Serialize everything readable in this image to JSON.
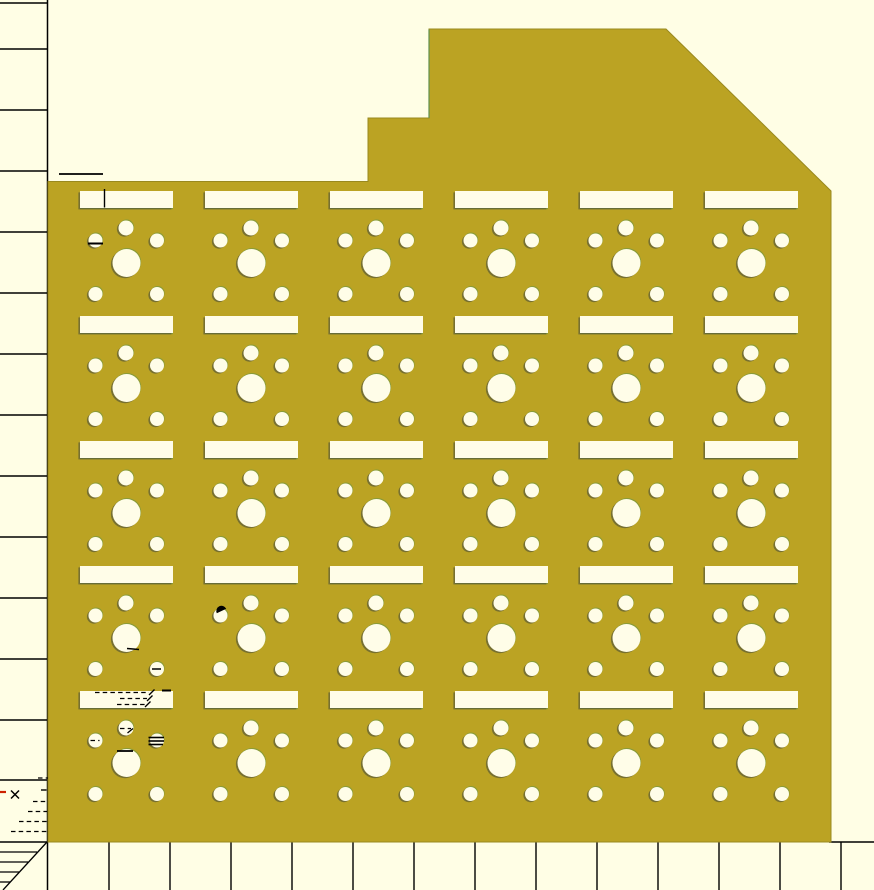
{
  "viewport": {
    "width": 874,
    "height": 890,
    "tool": "cad-preview-canvas"
  },
  "colors": {
    "background": "#fffee5",
    "panel": "#bba323",
    "panel_edge": "#99891f",
    "hole": "#fffde8",
    "line": "#000000",
    "accent_red": "#cc2200",
    "edge_green_line": "#5f9150",
    "shadow": "rgba(90,90,55,0.70)",
    "highlight_green": "rgba(95,150,75,0.55)"
  },
  "panel": {
    "outline": [
      [
        48,
        181.5
      ],
      [
        368,
        181.5
      ],
      [
        368,
        118
      ],
      [
        429,
        118
      ],
      [
        429,
        29
      ],
      [
        666,
        29
      ],
      [
        831,
        191
      ],
      [
        831,
        842
      ],
      [
        48,
        842
      ]
    ],
    "green_edge": [
      429,
      29.5,
      429,
      118
    ]
  },
  "cell_grid": {
    "columns_x": [
      80,
      205,
      330,
      455,
      580,
      705
    ],
    "rows_y": [
      191,
      316,
      441,
      566,
      691
    ],
    "slot": {
      "w": 93,
      "h": 17
    },
    "holes": [
      {
        "dx": 46,
        "dy": 37,
        "r": 7.5,
        "name": "top-hole"
      },
      {
        "dx": 15.5,
        "dy": 49.5,
        "r": 7,
        "name": "left-hole"
      },
      {
        "dx": 77,
        "dy": 49.5,
        "r": 7,
        "name": "right-hole"
      },
      {
        "dx": 46.5,
        "dy": 72,
        "r": 14,
        "name": "center-hole"
      },
      {
        "dx": 15.5,
        "dy": 103,
        "r": 7,
        "name": "bottom-left-hole"
      },
      {
        "dx": 77,
        "dy": 103,
        "r": 7,
        "name": "bottom-right-hole"
      }
    ]
  },
  "rulers": {
    "axis_x": 47.5,
    "left_tick_ys": [
      3,
      49,
      110,
      171,
      232,
      293,
      354,
      415,
      476,
      537,
      598,
      659,
      720,
      780
    ],
    "bottom_tick_xs": [
      109,
      170,
      231,
      292,
      353,
      414,
      475,
      536,
      597,
      658,
      719,
      780,
      841
    ],
    "bottom_tick_y1": 842,
    "bottom_tick_y2": 890,
    "baseline_y": 842,
    "baseline_segments": [
      [
        0,
        48
      ],
      [
        829,
        874
      ]
    ],
    "corner_hatch": {
      "lines": [
        [
          0,
          852,
          37,
          852
        ],
        [
          0,
          862,
          28,
          862
        ],
        [
          0,
          872,
          19,
          872
        ],
        [
          0,
          882,
          10,
          882
        ]
      ],
      "diagonal": [
        47,
        842,
        3,
        890
      ]
    }
  },
  "marks": [
    {
      "t": "l",
      "p": [
        59,
        174,
        103,
        174
      ],
      "w": 1.8
    },
    {
      "t": "l",
      "p": [
        104.5,
        189,
        104.5,
        207.5
      ],
      "w": 1.4
    },
    {
      "t": "l",
      "p": [
        88,
        243.5,
        103,
        243.5
      ],
      "w": 2
    },
    {
      "t": "wedge",
      "c": [
        221.5,
        611
      ],
      "r": 5.2,
      "a": -25
    },
    {
      "t": "l",
      "p": [
        127,
        648.5,
        139,
        649.5
      ],
      "w": 1.5
    },
    {
      "t": "l",
      "p": [
        152,
        669,
        161,
        669
      ],
      "w": 1.5
    },
    {
      "t": "d",
      "p": [
        95,
        692.5,
        149,
        692.5
      ],
      "w": 1.3
    },
    {
      "t": "l",
      "p": [
        149,
        695,
        154.5,
        689.5
      ],
      "w": 1.3
    },
    {
      "t": "d",
      "p": [
        120,
        698.5,
        147,
        698.5
      ],
      "w": 1.3
    },
    {
      "t": "l",
      "p": [
        147,
        701,
        152.5,
        695.5
      ],
      "w": 1.3
    },
    {
      "t": "d",
      "p": [
        117,
        704.5,
        145,
        704.5
      ],
      "w": 1.3
    },
    {
      "t": "l",
      "p": [
        145,
        707,
        150.5,
        701.5
      ],
      "w": 1.3
    },
    {
      "t": "l",
      "p": [
        162,
        690.5,
        171,
        690.5
      ],
      "w": 2
    },
    {
      "t": "d",
      "p": [
        120,
        728.5,
        131,
        728.5
      ],
      "w": 1.3
    },
    {
      "t": "l",
      "p": [
        127.5,
        733,
        133,
        728.5
      ],
      "w": 1.3
    },
    {
      "t": "d",
      "p": [
        90.5,
        740.5,
        99.5,
        740.5
      ],
      "w": 1.3
    },
    {
      "t": "l",
      "p": [
        148.5,
        737.5,
        164,
        737.5
      ],
      "w": 1.6
    },
    {
      "t": "l",
      "p": [
        148.5,
        741,
        164,
        741
      ],
      "w": 1.6
    },
    {
      "t": "l",
      "p": [
        148.5,
        744.5,
        163,
        744.5
      ],
      "w": 1.6
    },
    {
      "t": "l",
      "p": [
        117,
        751,
        133,
        751
      ],
      "w": 1.8
    },
    {
      "t": "d",
      "p": [
        38,
        778,
        48,
        778
      ],
      "w": 1.3
    },
    {
      "t": "l",
      "p": [
        0,
        792,
        6,
        792
      ],
      "w": 2.2,
      "c": "red"
    },
    {
      "t": "x",
      "c": [
        15,
        794.5
      ],
      "r": 4
    },
    {
      "t": "l",
      "p": [
        41,
        790,
        46.5,
        790
      ],
      "w": 1.4
    },
    {
      "t": "d",
      "p": [
        33,
        801.5,
        47,
        801.5
      ],
      "w": 1.3
    },
    {
      "t": "d",
      "p": [
        28,
        811.5,
        47,
        811.5
      ],
      "w": 1.3
    },
    {
      "t": "d",
      "p": [
        19,
        821.5,
        47,
        821.5
      ],
      "w": 1.3
    },
    {
      "t": "d",
      "p": [
        11,
        831.5,
        47,
        831.5
      ],
      "w": 1.3
    },
    {
      "t": "l",
      "p": [
        429,
        29.5,
        429,
        118
      ],
      "w": 1.2,
      "c": "green"
    }
  ]
}
